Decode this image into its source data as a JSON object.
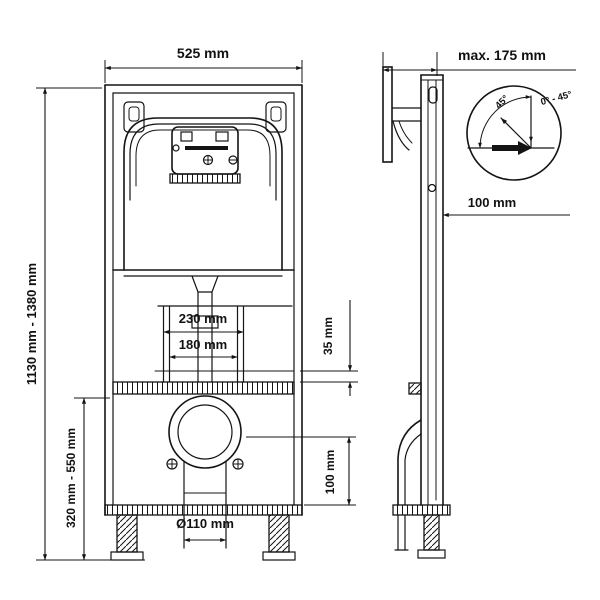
{
  "front": {
    "width": "525 mm",
    "height_range": "1130 mm - 1380 mm",
    "stud_spacing_outer": "230 mm",
    "stud_spacing_inner": "180 mm",
    "bracket_offset": "35 mm",
    "lower_height_range": "320 mm - 550 mm",
    "outlet_height": "100 mm",
    "outlet_diameter": "Ø110 mm"
  },
  "side": {
    "max_depth": "max. 175 mm",
    "wall_distance": "100 mm",
    "angle_value": "45°",
    "angle_range": "0° - 45°"
  },
  "colors": {
    "line": "#141414",
    "background": "#ffffff"
  }
}
